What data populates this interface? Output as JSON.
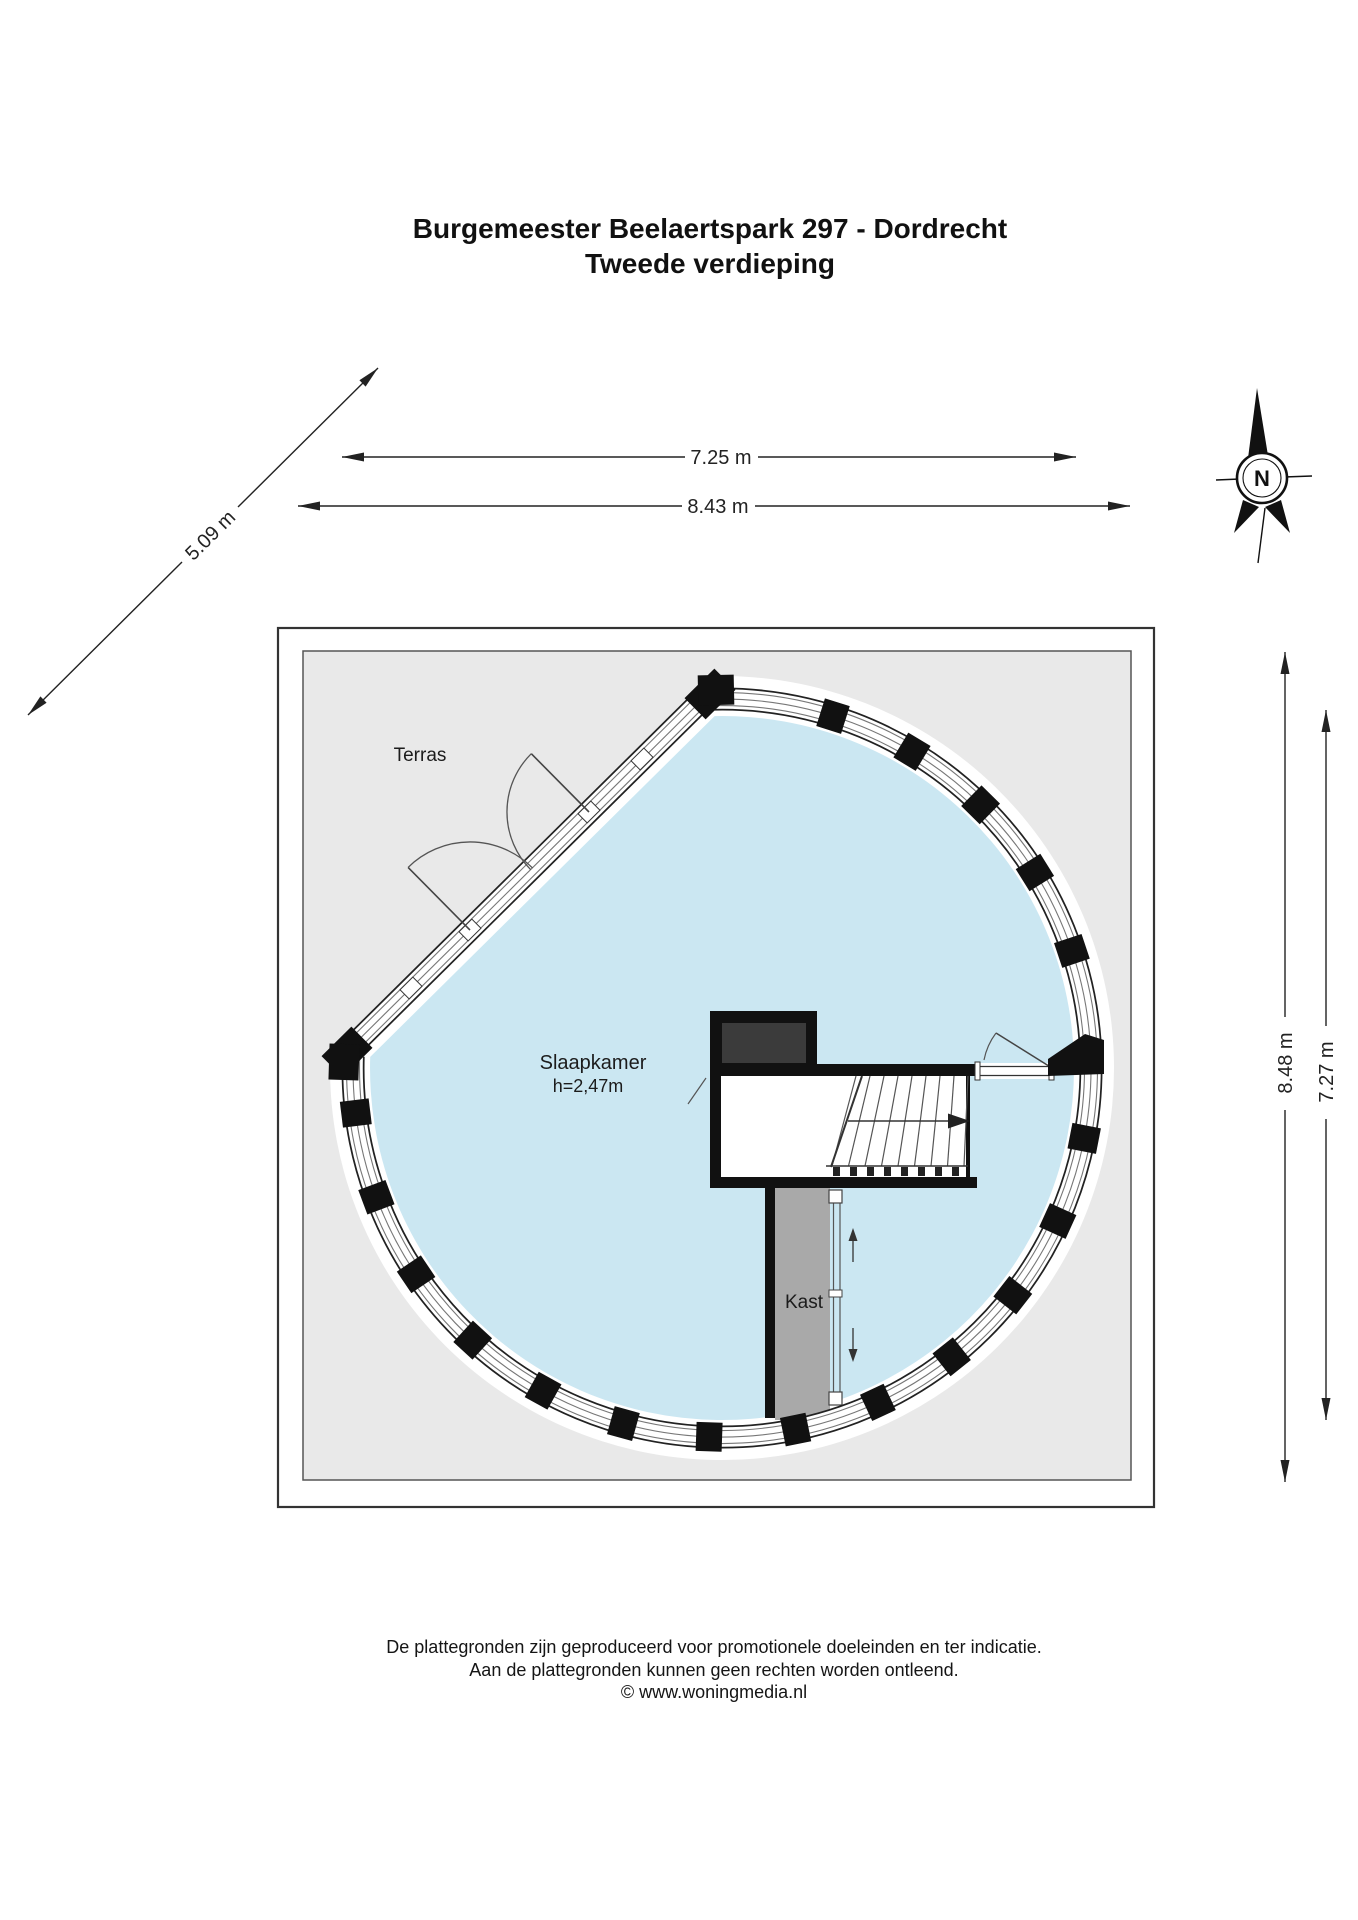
{
  "title": {
    "line1": "Burgemeester Beelaertspark 297 - Dordrecht",
    "line2": "Tweede verdieping"
  },
  "dimensions": {
    "top_inner": "7.25 m",
    "top_outer": "8.43 m",
    "diagonal": "5.09 m",
    "right_outer": "8.48 m",
    "right_inner": "7.27 m"
  },
  "compass": {
    "north_label": "N"
  },
  "rooms": {
    "terrace": "Terras",
    "bedroom": "Slaapkamer",
    "bedroom_height": "h=2,47m",
    "closet": "Kast"
  },
  "footer": {
    "line1": "De plattegronden zijn geproduceerd voor promotionele doeleinden en ter indicatie.",
    "line2": "Aan de plattegronden kunnen geen rechten worden ontleend.",
    "line3": "© www.woningmedia.nl"
  },
  "colors": {
    "room_fill": "#cbe7f2",
    "terrace_fill": "#e9e9e9",
    "closet_fill": "#a9a9a9",
    "shaft_fill": "#3b3b3b",
    "wall": "#111111"
  }
}
